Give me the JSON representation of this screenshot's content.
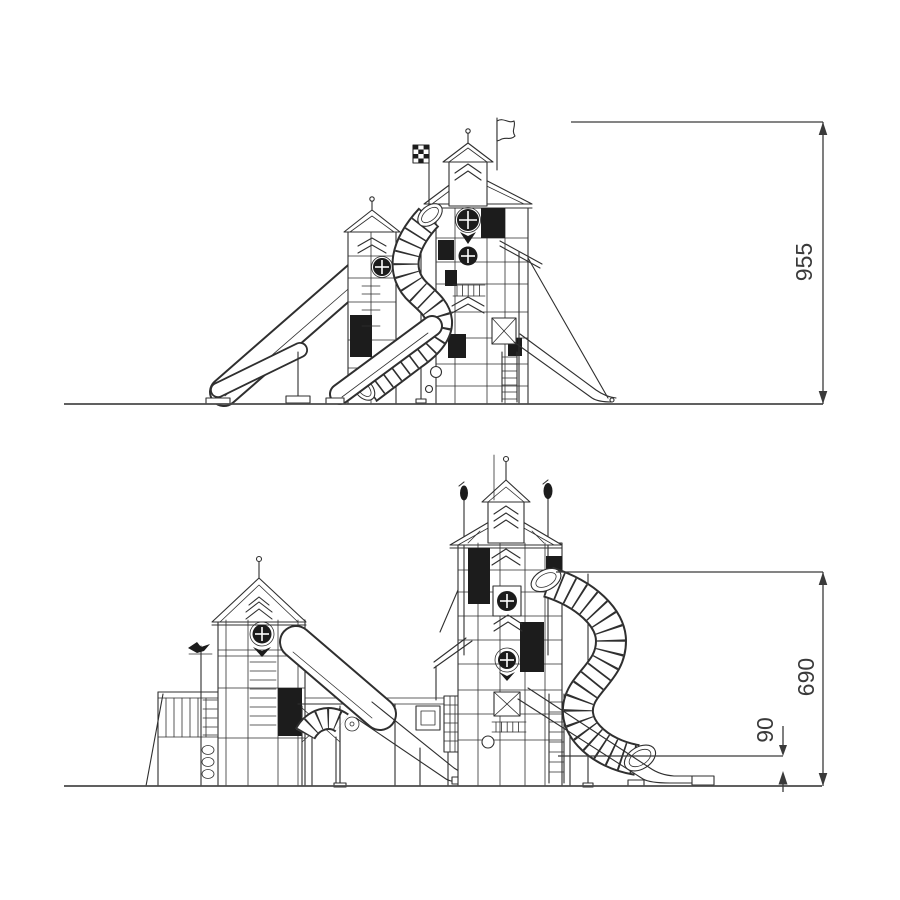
{
  "page": {
    "background": "#ffffff",
    "content": "technical elevation drawings of a playground tower structure, two views with height dimensions"
  },
  "colors": {
    "line": "#2f2f2f",
    "dimension": "#3a3a3a",
    "panel_fill": "#1c1c1c",
    "ground": "#4a4a4a"
  },
  "dimensions": {
    "upper_view": {
      "height_label": "955"
    },
    "lower_view": {
      "height_label": "690",
      "ground_offset_label": "90"
    }
  }
}
